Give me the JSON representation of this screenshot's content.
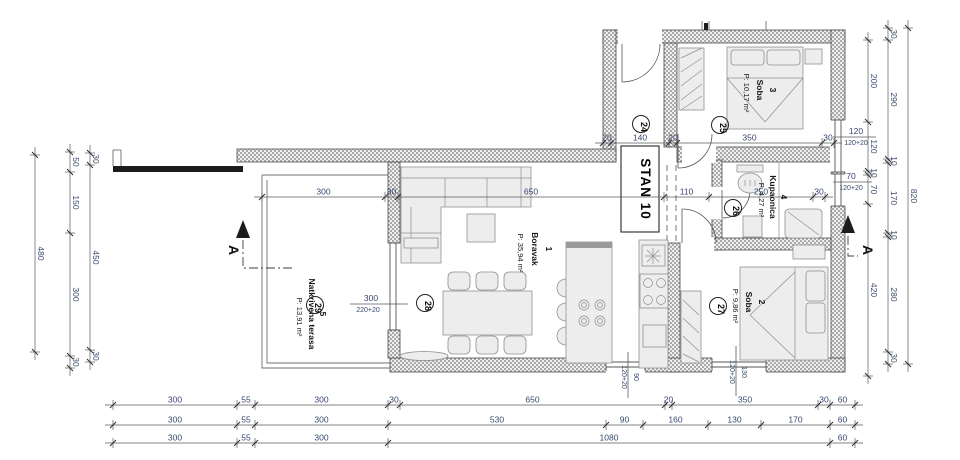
{
  "plan": {
    "title": "STAN 10",
    "section_mark": "A",
    "hall_marker": "24",
    "rooms": [
      {
        "number": "1",
        "name": "Boravak",
        "area": "P: 35,94 m²",
        "marker": "28"
      },
      {
        "number": "2",
        "name": "Soba",
        "area": "P: 9,86 m²",
        "marker": "27"
      },
      {
        "number": "3",
        "name": "Soba",
        "area": "P: 10,17 m²",
        "marker": "25"
      },
      {
        "number": "4",
        "name": "Kupaonica",
        "area": "P: 4,27 m²",
        "marker": "26"
      },
      {
        "number": "5",
        "name": "Natkrivena terasa",
        "area": "P: 13,91 m²",
        "marker": "29"
      }
    ]
  },
  "dimensions": {
    "bottom_row1": [
      "300",
      "55",
      "300",
      "30",
      "650",
      "20",
      "350",
      "30",
      "60"
    ],
    "bottom_row2": [
      "300",
      "55",
      "300",
      "530",
      "90",
      "160",
      "130",
      "170",
      "60"
    ],
    "bottom_row3": [
      "300",
      "55",
      "300",
      "1080",
      "60"
    ],
    "left_overall": [
      "480"
    ],
    "left_chain_a": [
      "50",
      "150",
      "300",
      "30"
    ],
    "left_chain_b": [
      "30",
      "450",
      "30"
    ],
    "right_chain_a": [
      "200",
      "120",
      "10",
      "70",
      "420"
    ],
    "right_chain_b": [
      "30",
      "290",
      "10",
      "170",
      "10",
      "280",
      "30"
    ],
    "right_overall": [
      "820"
    ],
    "upper_chain": [
      "20",
      "140",
      "20",
      "350",
      "30"
    ],
    "mid_chain": [
      "300",
      "30",
      "650",
      "110",
      "250",
      "30"
    ]
  },
  "openings": [
    [
      "120",
      "120+20"
    ],
    [
      "70",
      "120+20"
    ],
    [
      "90",
      "120+20"
    ],
    [
      "130",
      "120+20"
    ],
    [
      "300",
      "220+20"
    ]
  ],
  "annotations": [
    {
      "t": "3",
      "x": 770,
      "y": 90,
      "r": 1,
      "c": "rn"
    },
    {
      "t": "Soba",
      "x": 757,
      "y": 90,
      "r": 1,
      "c": "rn"
    },
    {
      "t": "P: 10,17 m²",
      "x": 744,
      "y": 93,
      "r": 1,
      "c": "ra"
    },
    {
      "t": "1",
      "x": 546,
      "y": 249,
      "r": 1,
      "c": "rn"
    },
    {
      "t": "Boravak",
      "x": 532,
      "y": 249,
      "r": 1,
      "c": "rn"
    },
    {
      "t": "P: 35,94 m²",
      "x": 518,
      "y": 253,
      "r": 1,
      "c": "ra"
    },
    {
      "t": "2",
      "x": 759,
      "y": 302,
      "r": 1,
      "c": "rn"
    },
    {
      "t": "Soba",
      "x": 746,
      "y": 302,
      "r": 1,
      "c": "rn"
    },
    {
      "t": "P: 9,86 m²",
      "x": 733,
      "y": 306,
      "r": 1,
      "c": "ra"
    },
    {
      "t": "4",
      "x": 781,
      "y": 197,
      "r": 1,
      "c": "rn"
    },
    {
      "t": "Kupaonica",
      "x": 770,
      "y": 197,
      "r": 1,
      "c": "rn"
    },
    {
      "t": "P: 4,27 m²",
      "x": 759,
      "y": 200,
      "r": 1,
      "c": "ra"
    },
    {
      "t": "5",
      "x": 320,
      "y": 314,
      "r": 1,
      "c": "rn"
    },
    {
      "t": "Natkrivena terasa",
      "x": 309,
      "y": 314,
      "r": 1,
      "c": "rn"
    },
    {
      "t": "P: 13,91 m²",
      "x": 297,
      "y": 317,
      "r": 1,
      "c": "ra"
    },
    {
      "t": "STAN 10",
      "x": 641,
      "y": 189,
      "r": 1,
      "c": "title"
    },
    {
      "t": "A",
      "x": 229,
      "y": 250,
      "r": 1,
      "c": "sec"
    },
    {
      "t": "A",
      "x": 863,
      "y": 250,
      "r": 1,
      "c": "sec"
    },
    {
      "t": "120",
      "x": 856,
      "y": 134,
      "c": "dim"
    },
    {
      "t": "120+20",
      "x": 856,
      "y": 145,
      "c": "dims"
    },
    {
      "t": "70",
      "x": 851,
      "y": 179,
      "c": "dim"
    },
    {
      "t": "120+20",
      "x": 851,
      "y": 190,
      "c": "dims"
    },
    {
      "t": "90",
      "x": 634,
      "y": 377,
      "r": 1,
      "c": "dims"
    },
    {
      "t": "120+20",
      "x": 622,
      "y": 377,
      "r": 1,
      "c": "dims"
    },
    {
      "t": "130",
      "x": 742,
      "y": 372,
      "r": 1,
      "c": "dims"
    },
    {
      "t": "120+20",
      "x": 730,
      "y": 372,
      "r": 1,
      "c": "dims"
    },
    {
      "t": "300",
      "x": 371,
      "y": 301,
      "c": "dim"
    },
    {
      "t": "220+20",
      "x": 368,
      "y": 312,
      "c": "dims"
    }
  ],
  "markers": [
    {
      "n": "24",
      "x": 641,
      "y": 124
    },
    {
      "n": "25",
      "x": 720,
      "y": 125
    },
    {
      "n": "26",
      "x": 733,
      "y": 208
    },
    {
      "n": "27",
      "x": 718,
      "y": 306
    },
    {
      "n": "28",
      "x": 425,
      "y": 303
    },
    {
      "n": "29",
      "x": 315,
      "y": 305
    }
  ],
  "colors": {
    "dim_text": "#37486e",
    "label_text": "#161616",
    "wall_hatch": "#a9a9a9",
    "background": "#ffffff"
  }
}
